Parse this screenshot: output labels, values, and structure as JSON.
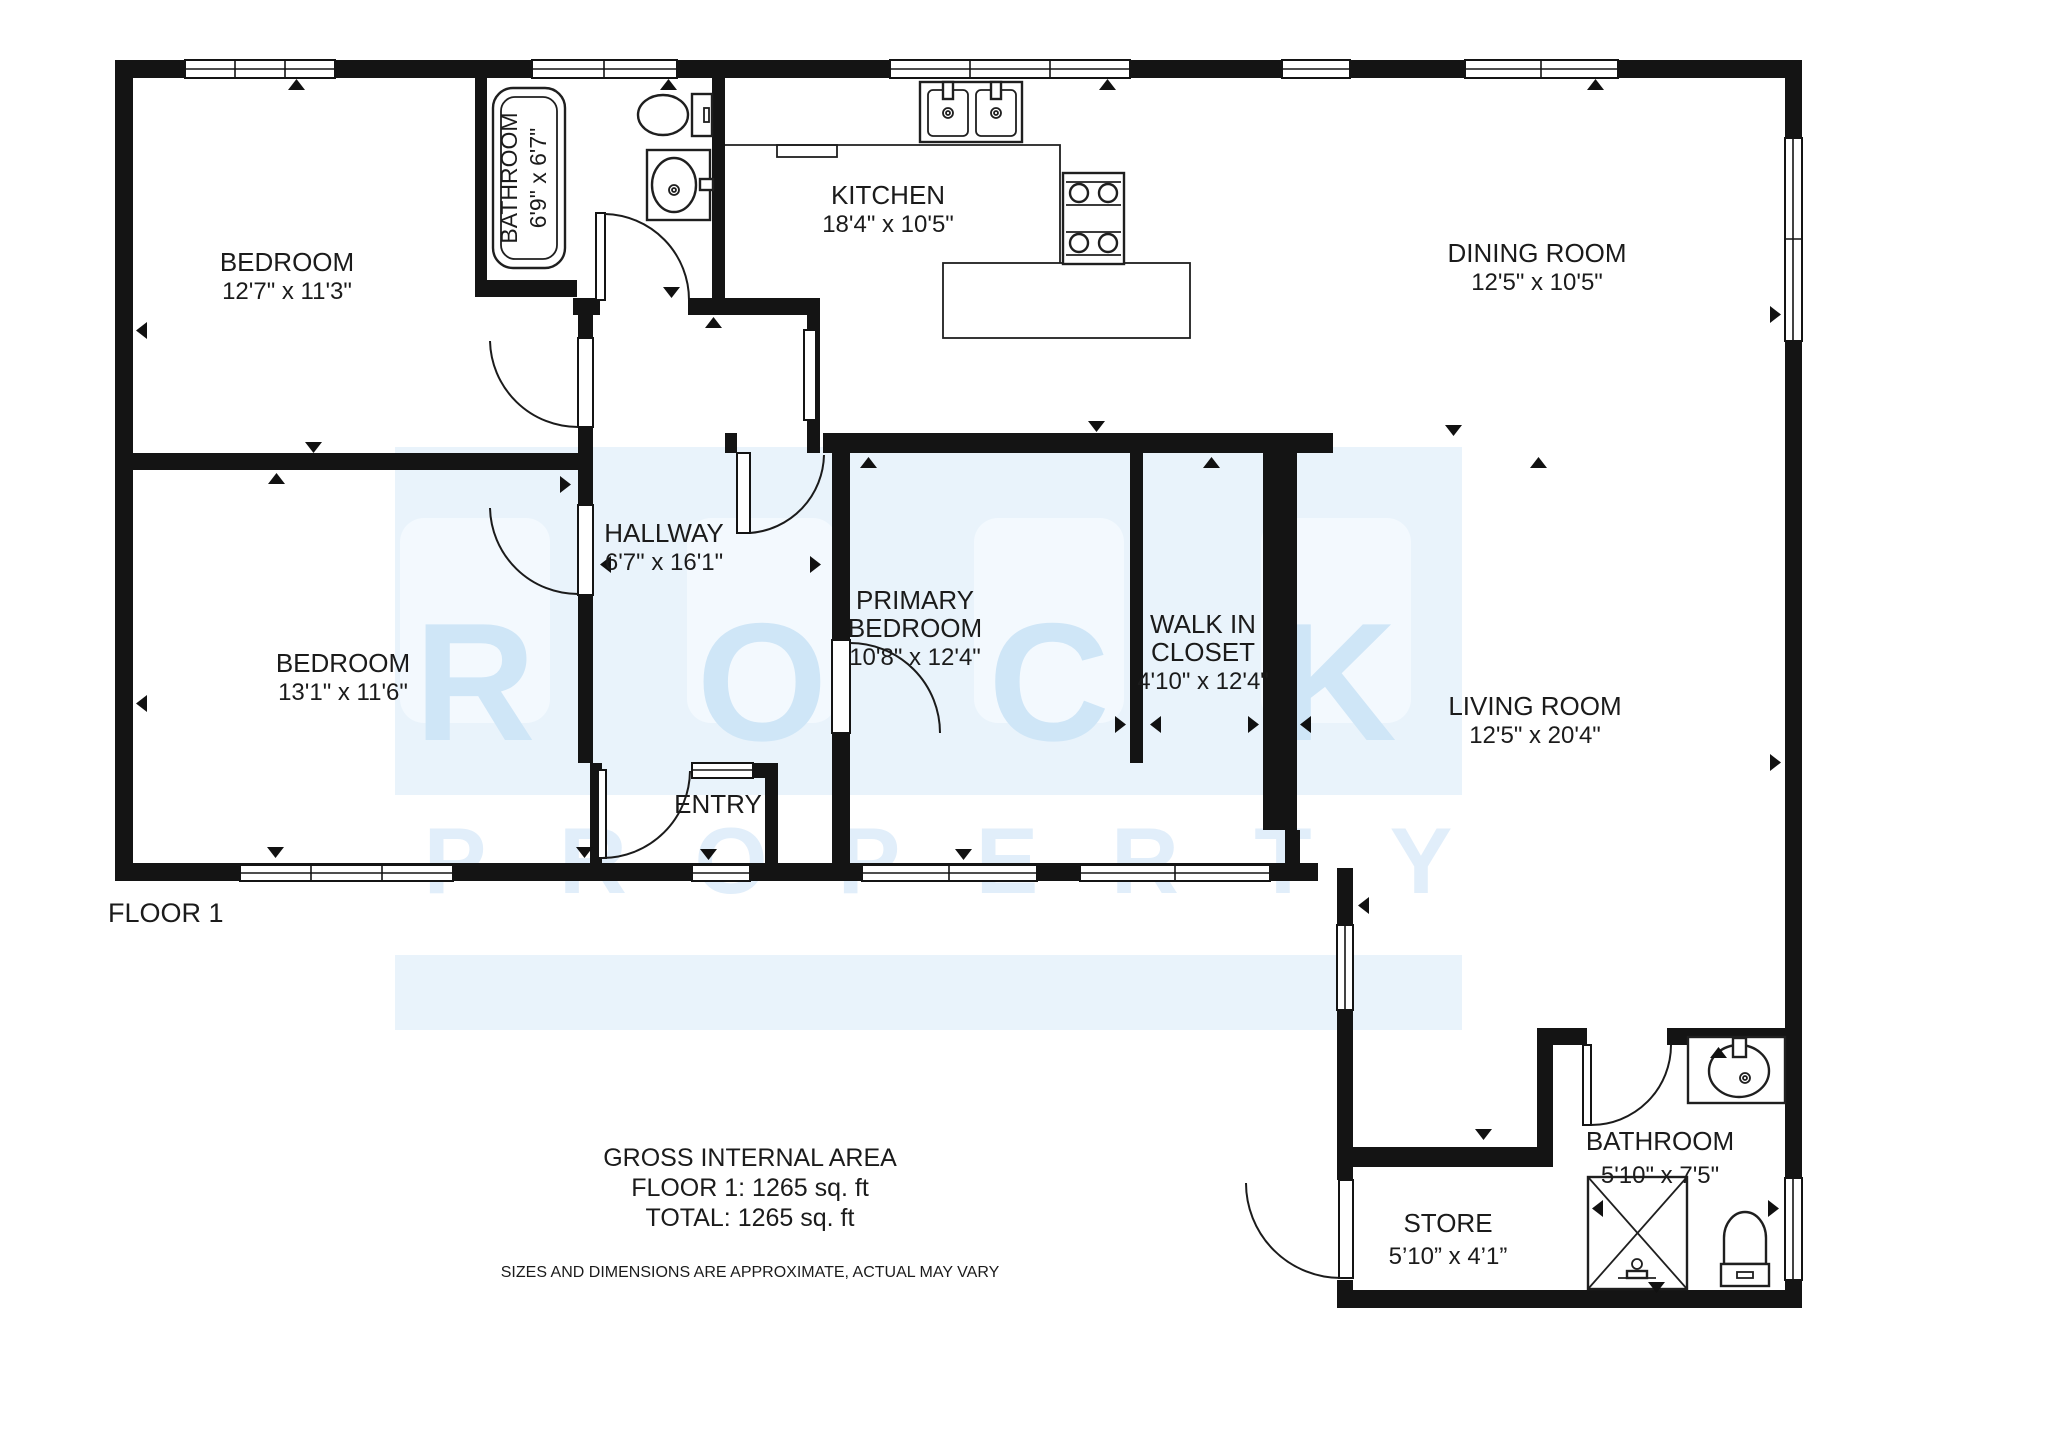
{
  "meta": {
    "type": "floor-plan",
    "brand_watermark": "ROCK PROPERTY",
    "colors": {
      "wall": "#141414",
      "text": "#1b1b1b",
      "watermark_band": "#e9f3fb",
      "watermark_tile": "#f3f9fe",
      "watermark_letter": "#cfe6f7"
    }
  },
  "watermark": {
    "rock": [
      "R",
      "O",
      "C",
      "K"
    ],
    "property": [
      "P",
      "R",
      "O",
      "P",
      "E",
      "R",
      "T",
      "Y"
    ]
  },
  "rooms": {
    "bedroom1": {
      "name": "BEDROOM",
      "dims": "12'7\" x 11'3\""
    },
    "bathroom1": {
      "name": "BATHROOM",
      "dims": "6'9\" x 6'7\""
    },
    "kitchen": {
      "name": "KITCHEN",
      "dims": "18'4\" x 10'5\""
    },
    "dining": {
      "name": "DINING ROOM",
      "dims": "12'5\" x 10'5\""
    },
    "hallway": {
      "name": "HALLWAY",
      "dims": "6'7\" x 16'1\""
    },
    "bedroom2": {
      "name": "BEDROOM",
      "dims": "13'1\" x 11'6\""
    },
    "primary": {
      "name1": "PRIMARY",
      "name2": "BEDROOM",
      "dims": "10'8\" x 12'4\""
    },
    "closet": {
      "name1": "WALK IN",
      "name2": "CLOSET",
      "dims": "4'10\" x 12'4\""
    },
    "living": {
      "name": "LIVING ROOM",
      "dims": "12'5\" x 20'4\""
    },
    "entry": {
      "name": "ENTRY"
    },
    "bathroom2": {
      "name": "BATHROOM",
      "dims": "5'10\" x 7'5\""
    },
    "store": {
      "name": "STORE",
      "dims": "5’10” x 4’1”"
    }
  },
  "footer": {
    "floor_label": "FLOOR 1",
    "area_title": "GROSS INTERNAL AREA",
    "area_floor": "FLOOR 1: 1265 sq. ft",
    "area_total": "TOTAL: 1265 sq. ft",
    "disclaimer": "SIZES AND DIMENSIONS ARE APPROXIMATE, ACTUAL MAY VARY"
  }
}
